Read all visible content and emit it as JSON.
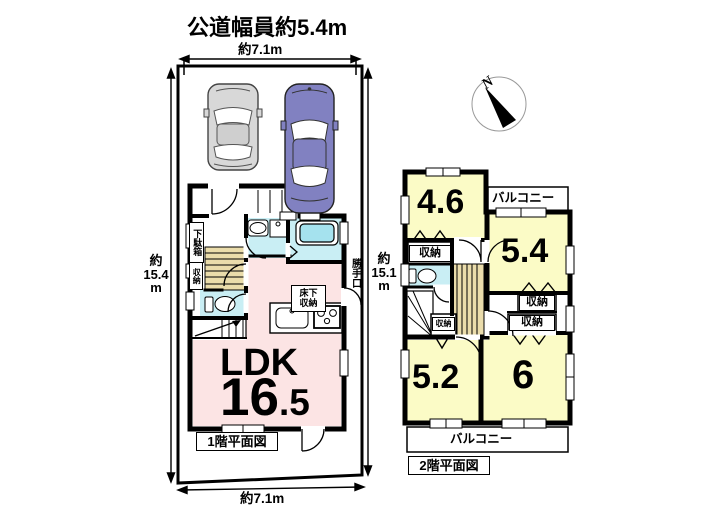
{
  "site": {
    "road_width_label": "公道幅員約5.4m",
    "top_width": "約7.1m",
    "bottom_width": "約7.1m",
    "left_depth": {
      "approx": "約",
      "value": "15.4",
      "unit": "m"
    },
    "right_depth": {
      "approx": "約",
      "value": "15.1",
      "unit": "m"
    }
  },
  "compass": {
    "north_label": "N"
  },
  "floor1": {
    "caption": "1階平面図",
    "ldk_label": "LDK",
    "ldk_size_int": "16",
    "ldk_size_frac": ".5",
    "shoe_cabinet_label": "下駄箱",
    "storage_label": "収納",
    "underfloor_storage_top": "床下",
    "underfloor_storage_bottom": "収納",
    "back_door_label": "勝手口"
  },
  "floor2": {
    "caption": "2階平面図",
    "room_sizes": {
      "top_left": "4.6",
      "top_right": "5.4",
      "bottom_left": "5.2",
      "bottom_right": "6"
    },
    "closet_label": "収納",
    "balcony_top_label": "バルコニー",
    "balcony_bottom_label": "バルコニー"
  },
  "colors": {
    "room_pink": "#fce4e4",
    "room_yellow": "#fbfbc6",
    "wet_cyan": "#c9eef4",
    "tub_cyan": "#a5e2ee",
    "stair_tan": "#eadcab",
    "car_gray": "#d8d8d8",
    "car_blue": "#8181c1",
    "wall_black": "#000000"
  }
}
